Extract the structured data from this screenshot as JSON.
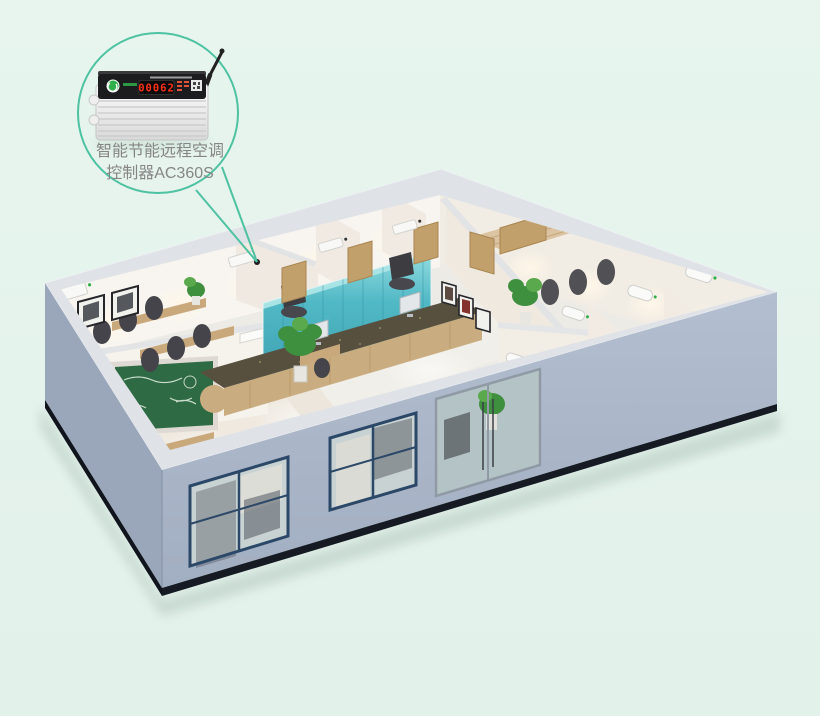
{
  "callout": {
    "label_line1": "智能节能远程空调",
    "label_line2": "控制器AC360S",
    "text_color": "#868686",
    "accent_color": "#4ec2a1"
  },
  "device": {
    "display_value": "00062",
    "display_color": "#ff3018",
    "panel_color": "#1c1c1e",
    "body_color": "#f2f2f2",
    "logo_color": "#2fae4a",
    "antenna_color": "#222222"
  },
  "scene": {
    "background_color": "#e5f3ed",
    "colors": {
      "exterior_wall_front": "#aab6c8",
      "exterior_wall_side": "#9aa7ba",
      "plinth": "#151a23",
      "wall_top": "#dfe3e7",
      "interior_wall": "#f7f4ef",
      "floor": "#ecebe6",
      "glass_partition": "#3aa8b8",
      "chalkboard": "#2e6b44",
      "window_frame": "#2c4868",
      "wood": "#c9a97c",
      "chair": "#44444a",
      "plant": "#3e8f3e",
      "counter_top": "#57503f",
      "ac_unit": "#f8f8f6",
      "ac_indicator": "#2fae4a"
    }
  }
}
